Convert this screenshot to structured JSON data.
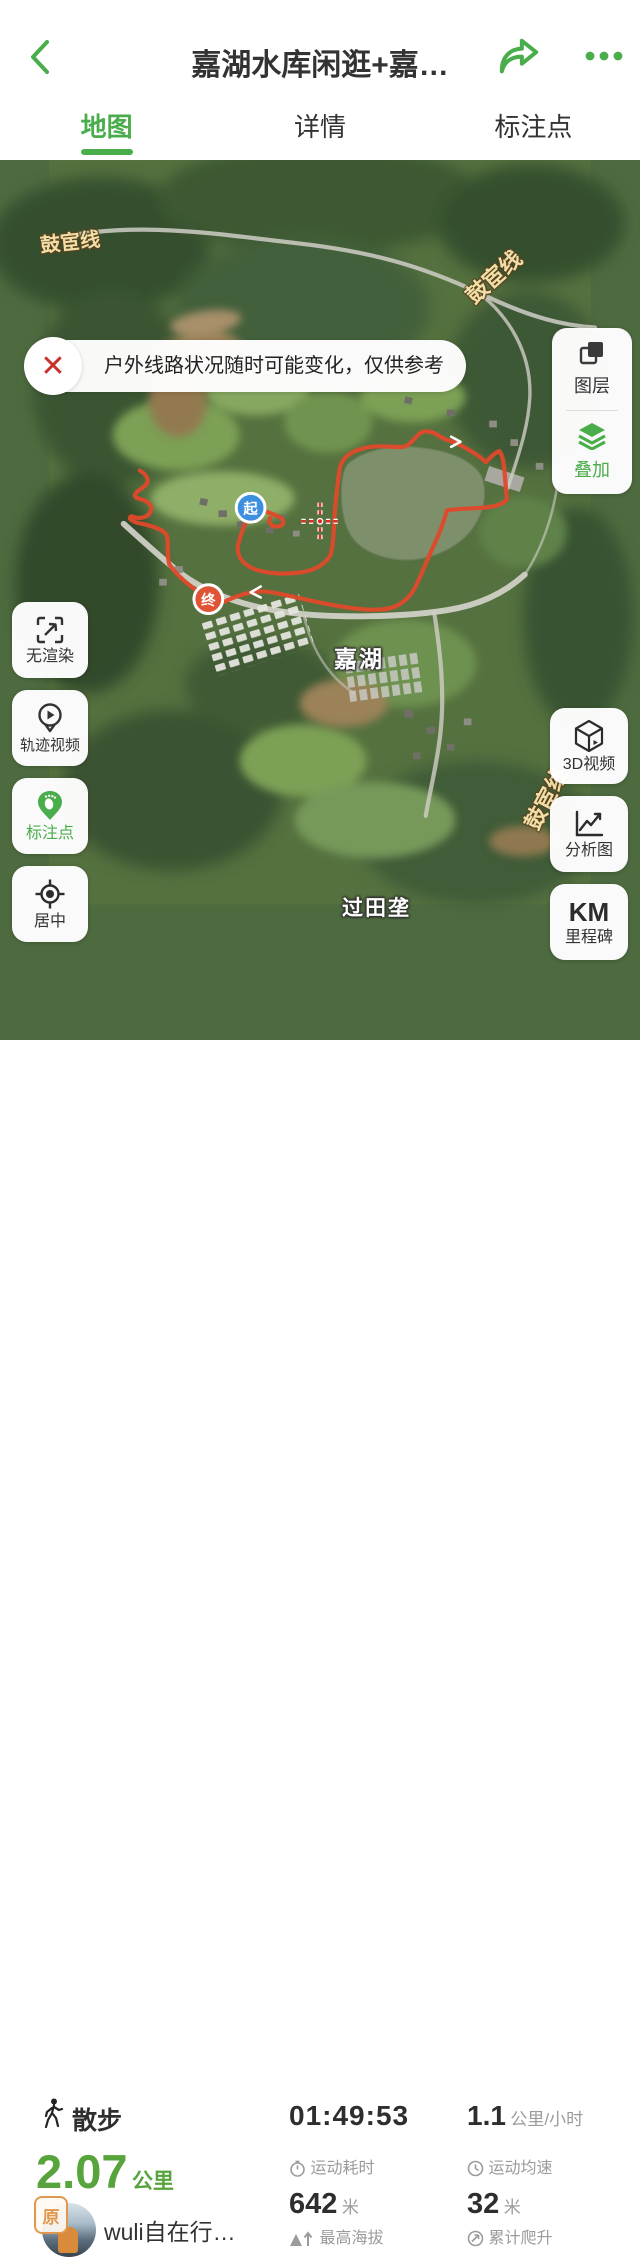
{
  "nav": {
    "title": "嘉湖水库闲逛+嘉…",
    "back_icon": "chevron-left",
    "share_icon": "share-arrow",
    "more_icon": "ellipsis"
  },
  "tabs": [
    {
      "label": "地图",
      "active": true
    },
    {
      "label": "详情",
      "active": false
    },
    {
      "label": "标注点",
      "active": false
    }
  ],
  "map": {
    "alert": {
      "text": "户外线路状况随时可能变化，仅供参考",
      "close_icon": "✕"
    },
    "right_top_buttons": [
      {
        "label": "图层",
        "icon": "layers-squares"
      },
      {
        "label": "叠加",
        "icon": "stack-layers"
      }
    ],
    "left_buttons": [
      {
        "label": "无渲染",
        "icon": "expand-arrow"
      },
      {
        "label": "轨迹视频",
        "icon": "play-pin"
      },
      {
        "label": "标注点",
        "icon": "footprint-pin"
      },
      {
        "label": "居中",
        "icon": "center-target"
      }
    ],
    "right_bottom_buttons": [
      {
        "label": "3D视频",
        "icon": "cube-play"
      },
      {
        "label": "分析图",
        "icon": "line-chart"
      },
      {
        "label_top": "KM",
        "label": "里程碑",
        "icon": "text-km"
      }
    ],
    "markers": {
      "start": "起",
      "end": "终"
    },
    "labels": {
      "road": "鼓宦线",
      "lake": "嘉湖",
      "village": "过田垄"
    },
    "scale": "100m",
    "attribution_line1": "数据来自于: 中华人民共和国自然资源部",
    "attribution_line2": "GS (2025) 1508号"
  },
  "stats": {
    "activity": "散步",
    "duration": {
      "value": "01:49:53",
      "label": "运动耗时"
    },
    "avg_speed": {
      "value": "1.1",
      "unit": "公里/小时",
      "label": "运动均速"
    },
    "distance": {
      "value": "2.07",
      "unit": "公里"
    },
    "max_altitude": {
      "value": "642",
      "unit": "米",
      "label": "最高海拔"
    },
    "total_climb": {
      "value": "32",
      "unit": "米",
      "label": "累计爬升"
    },
    "user": {
      "name": "wuli自在行…",
      "badge": "原"
    }
  },
  "colors": {
    "accent_green": "#4aad4b",
    "track_red": "#e0492b",
    "start_blue": "#3d8fe0",
    "end_orange": "#e05335",
    "distance_green": "#57a33c"
  }
}
